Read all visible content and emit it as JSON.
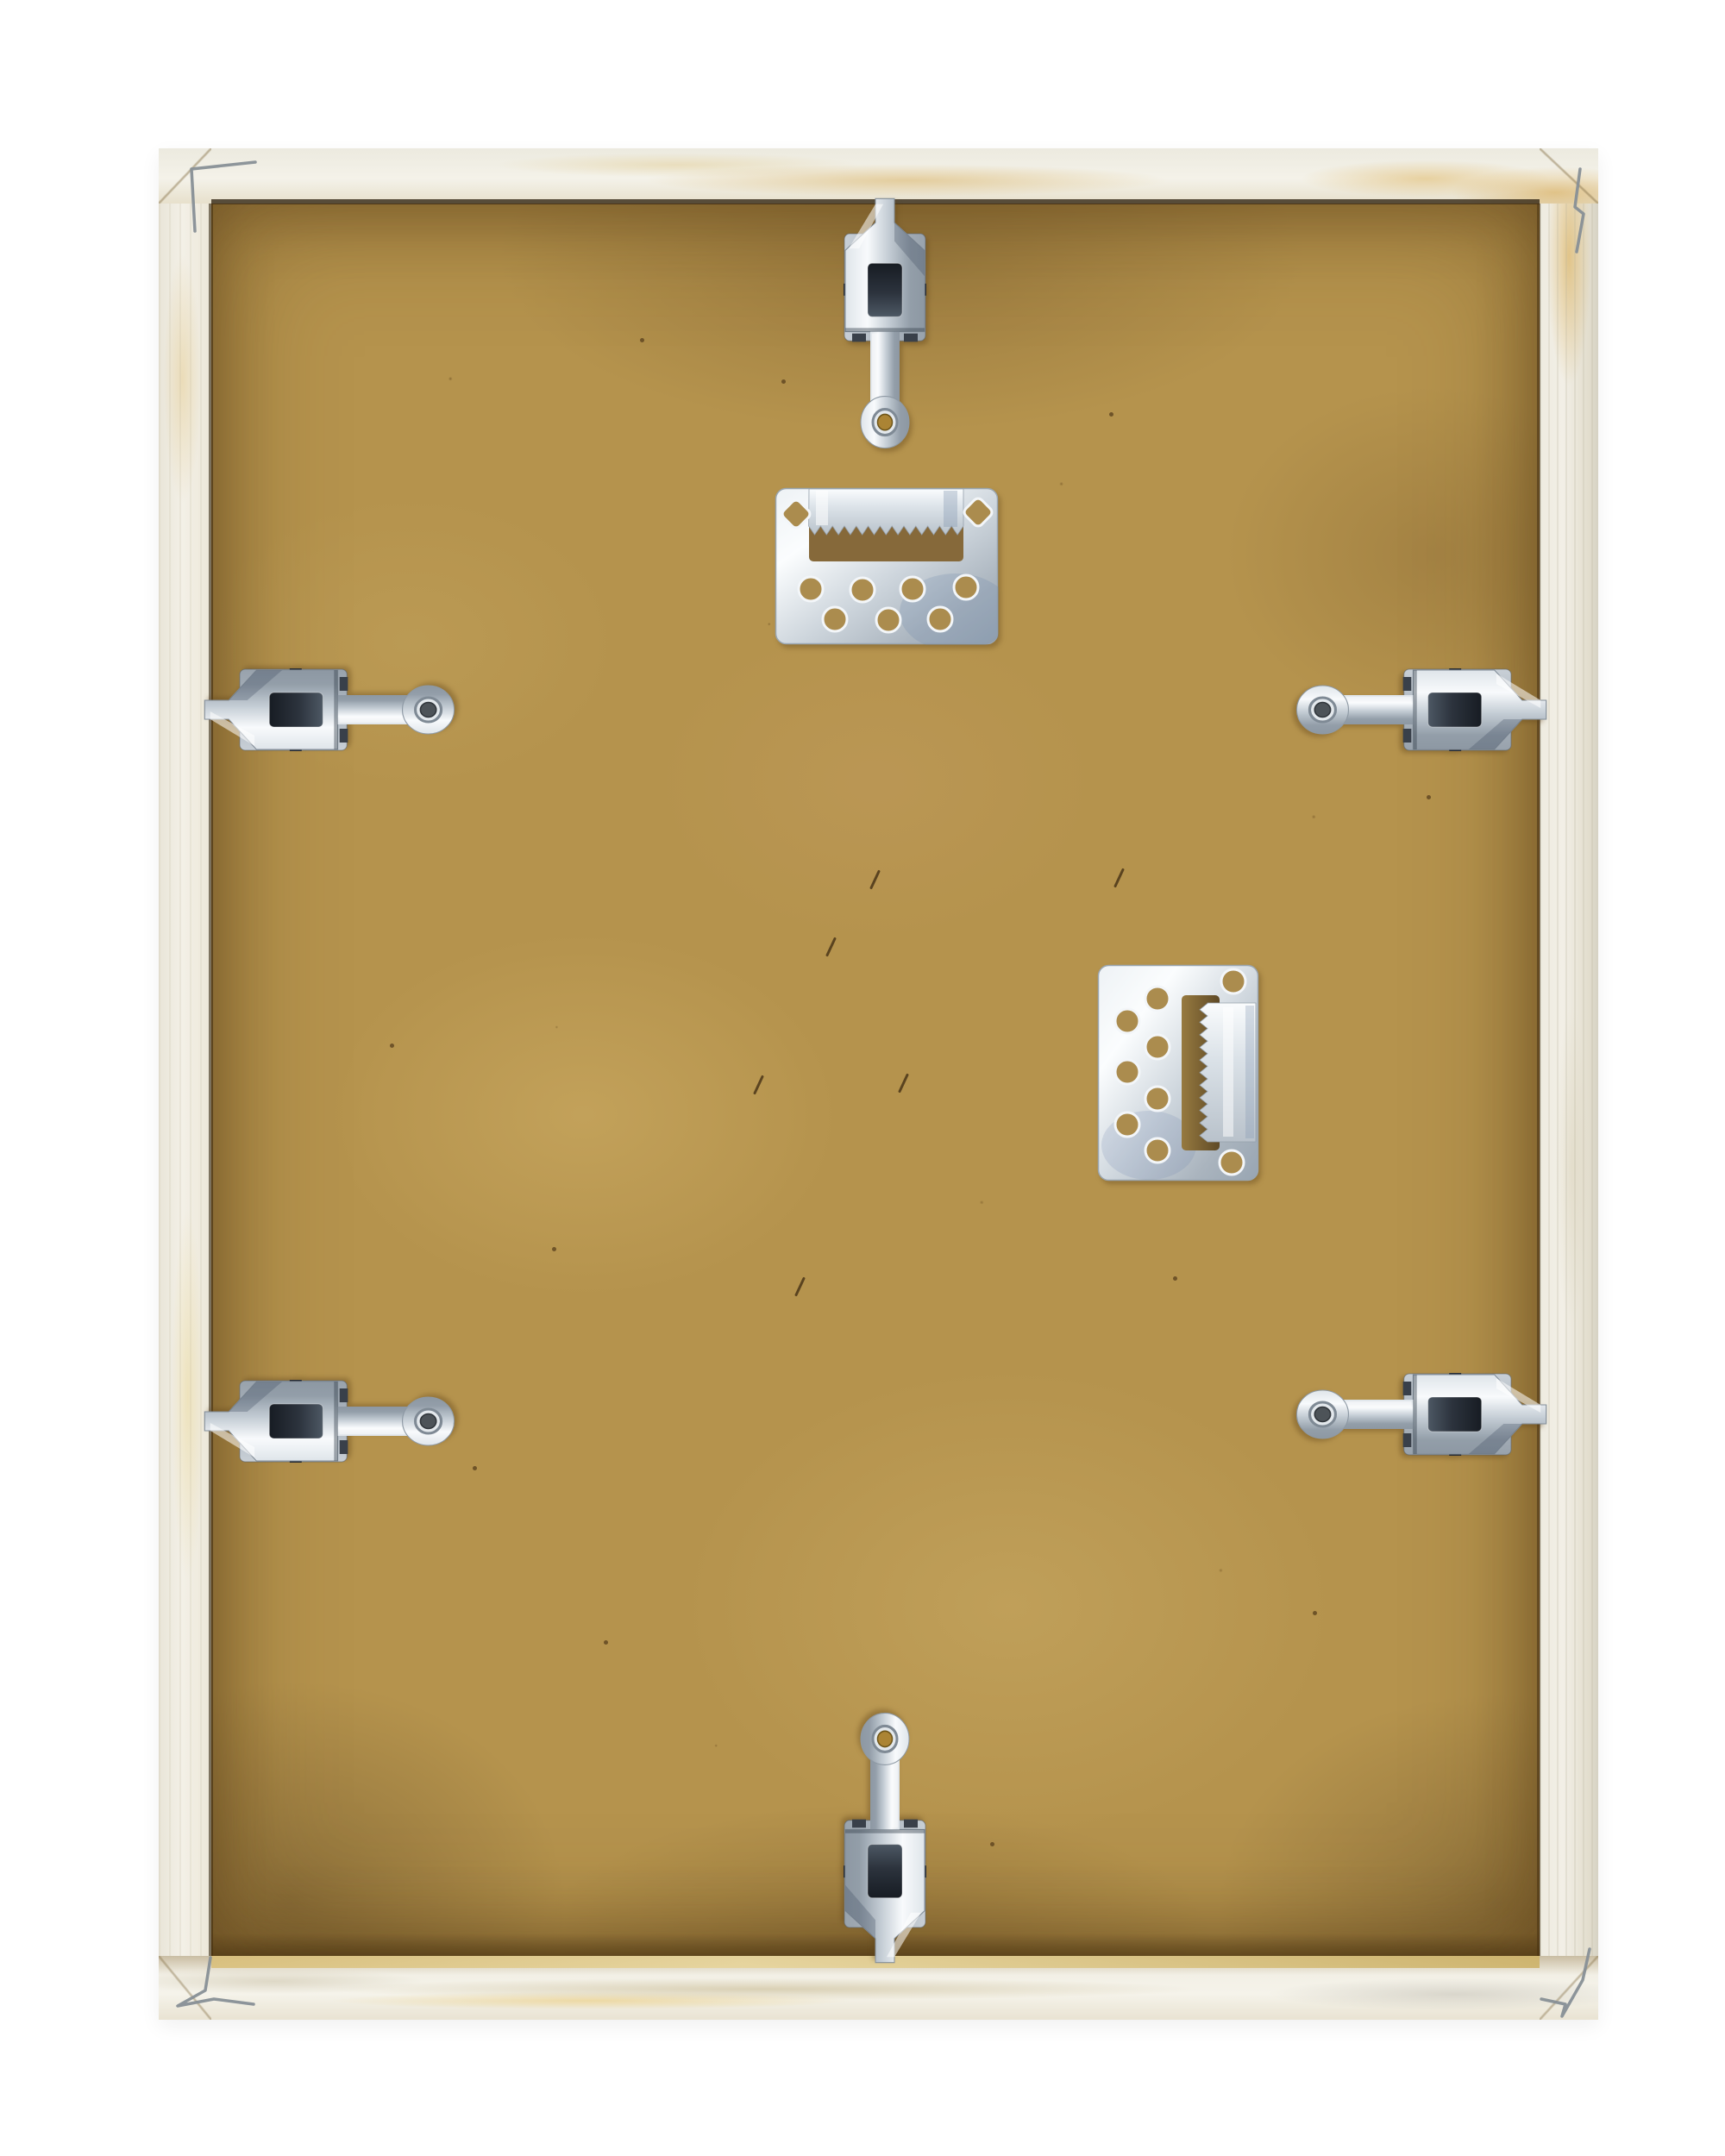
{
  "scene": {
    "type": "photograph",
    "subject": "Back of a wooden picture frame",
    "description": "Rear view of a light raw-pine picture frame with a tan MDF backing board held in by six metal flexi spring clips, two no-nail sawtooth hanger plates, and small V-nail staples in the four mitred corners",
    "background": "plain white"
  },
  "frame": {
    "material": "raw pine wood, unfinished",
    "backing": "MDF hardboard",
    "orientation": "portrait"
  },
  "hardware": {
    "flexi_clips": {
      "count": 6,
      "type": "spring flexi clip with screw-hole tongue",
      "positions": [
        "top-center",
        "upper-left",
        "upper-right",
        "lower-left",
        "lower-right",
        "bottom-center"
      ],
      "screws": {
        "brass": 2,
        "dark": 4
      }
    },
    "sawtooth_hangers": {
      "count": 2,
      "type": "no-nail sawtooth hanger plate",
      "positions": [
        "top-center horizontal",
        "middle-right vertical"
      ],
      "holes_per_plate": 9
    },
    "corner_staples": {
      "count": 4
    }
  },
  "colors": {
    "background": "#ffffff",
    "wood_light": "#f2efe5",
    "wood_grain": "#e3d3a6",
    "wood_amber": "#ddb45e",
    "mdf_base": "#b5934d",
    "mdf_light": "#c9aa62",
    "mdf_dark": "#8d7138",
    "mdf_window": "#86693a",
    "mdf_hole": "#ab8c4e",
    "rabbet_shadow": "#2e2110",
    "metal_light": "#f4f7f9",
    "metal_mid": "#c2cbd4",
    "metal_dark": "#7e8994",
    "slot_dark": "#262b33",
    "screw_brass": "#ab8434",
    "screw_dark": "#4d5358",
    "staple_gray": "#878f96"
  }
}
